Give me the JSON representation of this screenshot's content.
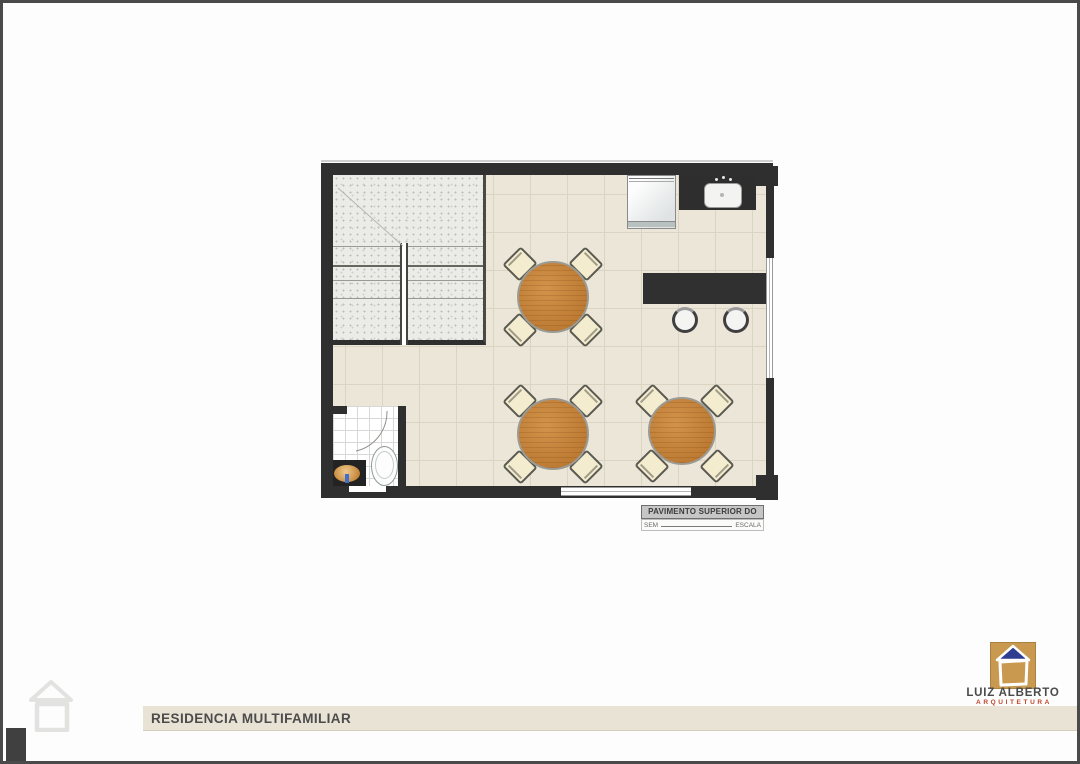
{
  "sheet": {
    "title": "RESIDENCIA MULTIFAMILIAR"
  },
  "plan_caption": {
    "title": "PAVIMENTO SUPERIOR DO DECK",
    "scale_prefix": "SEM",
    "scale_suffix": "ESCALA"
  },
  "logo": {
    "name": "LUIZ ALBERTO",
    "subtitle": "ARQUITETURA"
  },
  "colors": {
    "wall": "#2f2f2f",
    "floor_tile": "#ece6d8",
    "grout": "#dcd4c2",
    "counter": "#303030",
    "table_wood": "#c5813a",
    "chair": "#f4ecce",
    "stair_texture": "#ebebe8",
    "vanity_bowl": "#d09a55",
    "logo_tan": "#c9994f",
    "logo_roof_blue": "#2e3d90",
    "logo_subtitle_red": "#c1452b",
    "band_beige": "#e9e3d5",
    "title_text": "#4c4c4c"
  }
}
